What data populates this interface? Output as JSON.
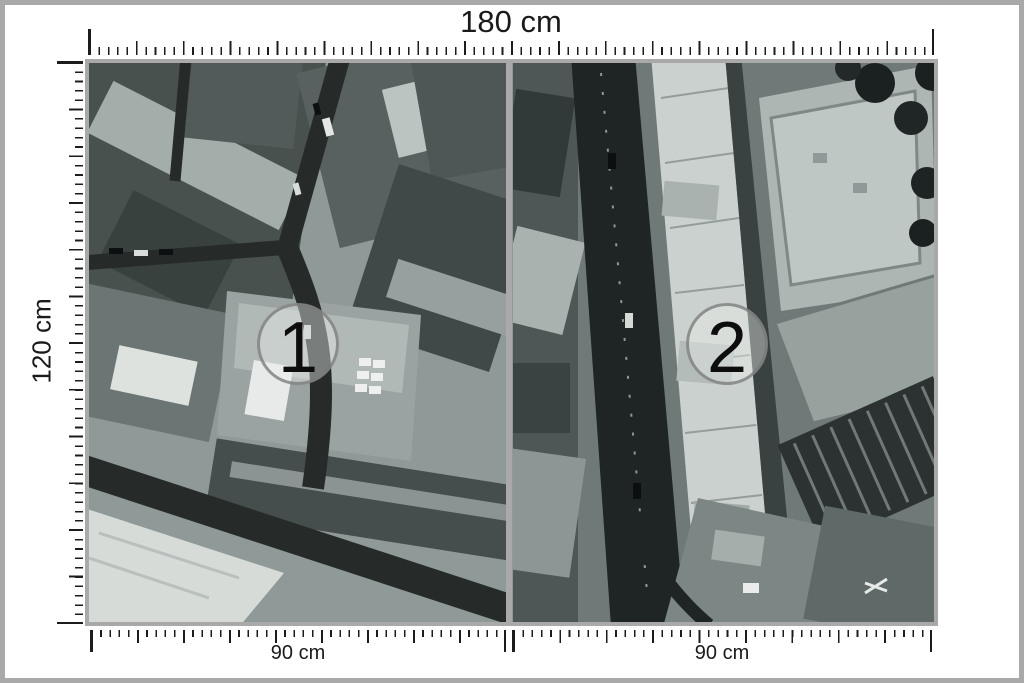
{
  "dimensions": {
    "total_width": "180 cm",
    "total_height": "120 cm",
    "panel_widths": [
      "90 cm",
      "90 cm"
    ]
  },
  "panels": [
    {
      "number": "1"
    },
    {
      "number": "2"
    }
  ],
  "colors": {
    "frame_gray": "#a9a9a9",
    "tick_black": "#1c1c1c",
    "label_black": "#1a1a1a",
    "photo_base_tone": "#8f9998",
    "badge_fill": "rgba(236,239,237,0.42)",
    "badge_border": "rgba(120,122,121,0.78)"
  }
}
